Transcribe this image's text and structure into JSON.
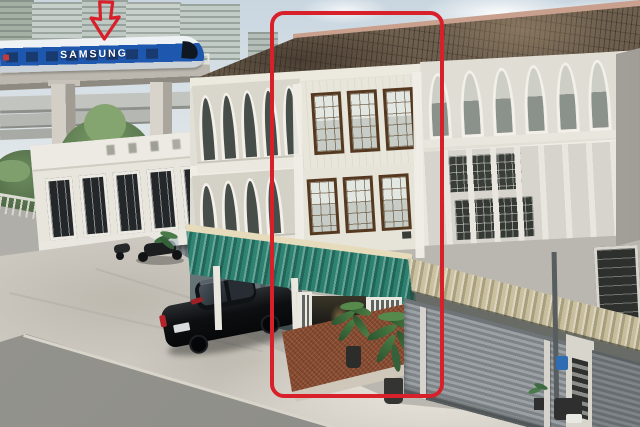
{
  "scene": {
    "description": "Aerial daytime photo of a white three-storey shophouse row with arched balconies and teal and cream awnings; the centre unit is outlined with a red rounded rectangle; a red arrow points to a Samsung-liveried monorail train on an elevated track in front of high-rise condominiums; a black sedan is parked in the concrete forecourt.",
    "train_brand_text": "SAMSUNG"
  },
  "annotations": {
    "box_color": "#d7202a",
    "arrow_color": "#d7202a"
  },
  "palette": {
    "sky_top": "#c9d6e0",
    "sky_low": "#eef0ee",
    "train_blue": "#1d57ae",
    "roof_brown": "#5e5143",
    "ridge_pink": "#c9a08d",
    "facade_cream": "#e7e4da",
    "awning_teal": "#2e8c7a",
    "awning_cream": "#d6ccab",
    "shutter_gray": "#8d9296",
    "brick_red": "#8a4c31",
    "concrete": "#ccc8c0",
    "asphalt": "#8b8b87",
    "foliage": "#5d7c52"
  }
}
